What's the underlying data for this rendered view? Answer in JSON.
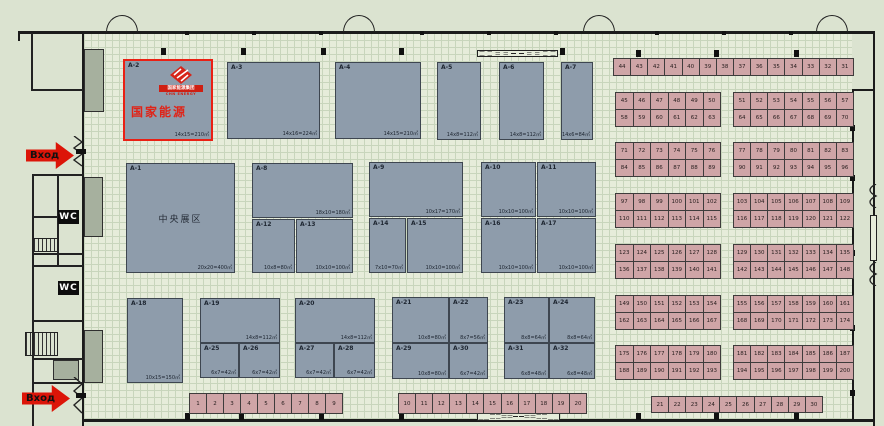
{
  "colors": {
    "highlight_red": "#ea2014",
    "booth_fill": "#8e9cab",
    "small_booth_fill": "#cfa5a7",
    "logo_red": "#cf1f12",
    "entrance_red": "#dc1508",
    "wall": "#1b1b1b"
  },
  "left_area": {
    "entrance_top_label": "Вход",
    "entrance_bottom_label": "Вход",
    "wc_label": "WC"
  },
  "hall": {
    "a2_branding": {
      "logo_banner": "国家能源集团",
      "logo_sub": "CHN ENERGY",
      "name_text": "国家能源"
    },
    "large_booths": [
      {
        "id": "A-2",
        "x": 123,
        "y": 59,
        "w": 90,
        "h": 82,
        "size": "14x15=210㎡",
        "highlight": true
      },
      {
        "id": "A-3",
        "x": 227,
        "y": 62,
        "w": 93,
        "h": 77,
        "size": "14x16=224㎡"
      },
      {
        "id": "A-4",
        "x": 335,
        "y": 62,
        "w": 86,
        "h": 77,
        "size": "14x15=210㎡"
      },
      {
        "id": "A-5",
        "x": 437,
        "y": 62,
        "w": 44,
        "h": 78,
        "size": "14x8=112㎡"
      },
      {
        "id": "A-6",
        "x": 499,
        "y": 62,
        "w": 45,
        "h": 78,
        "size": "14x8=112㎡"
      },
      {
        "id": "A-7",
        "x": 561,
        "y": 62,
        "w": 32,
        "h": 78,
        "size": "14x6=84㎡"
      },
      {
        "id": "A-1",
        "x": 126,
        "y": 163,
        "w": 109,
        "h": 110,
        "size": "20x20=400㎡",
        "center": "中央展区"
      },
      {
        "id": "A-8",
        "x": 252,
        "y": 163,
        "w": 101,
        "h": 55,
        "size": "18x10=180㎡"
      },
      {
        "id": "A-12",
        "x": 252,
        "y": 219,
        "w": 43,
        "h": 54,
        "size": "10x8=80㎡"
      },
      {
        "id": "A-13",
        "x": 296,
        "y": 219,
        "w": 57,
        "h": 54,
        "size": "10x10=100㎡"
      },
      {
        "id": "A-9",
        "x": 369,
        "y": 162,
        "w": 94,
        "h": 55,
        "size": "10x17=170㎡"
      },
      {
        "id": "A-14",
        "x": 369,
        "y": 218,
        "w": 37,
        "h": 55,
        "size": "7x10=70㎡"
      },
      {
        "id": "A-15",
        "x": 407,
        "y": 218,
        "w": 56,
        "h": 55,
        "size": "10x10=100㎡"
      },
      {
        "id": "A-10",
        "x": 481,
        "y": 162,
        "w": 55,
        "h": 55,
        "size": "10x10=100㎡"
      },
      {
        "id": "A-11",
        "x": 537,
        "y": 162,
        "w": 59,
        "h": 55,
        "size": "10x10=100㎡"
      },
      {
        "id": "A-16",
        "x": 481,
        "y": 218,
        "w": 55,
        "h": 55,
        "size": "10x10=100㎡"
      },
      {
        "id": "A-17",
        "x": 537,
        "y": 218,
        "w": 59,
        "h": 55,
        "size": "10x10=100㎡"
      },
      {
        "id": "A-18",
        "x": 127,
        "y": 298,
        "w": 56,
        "h": 85,
        "size": "10x15=150㎡"
      },
      {
        "id": "A-19",
        "x": 200,
        "y": 298,
        "w": 80,
        "h": 45,
        "size": "14x8=112㎡"
      },
      {
        "id": "A-25",
        "x": 200,
        "y": 343,
        "w": 39,
        "h": 35,
        "size": "6x7=42㎡"
      },
      {
        "id": "A-26",
        "x": 239,
        "y": 343,
        "w": 41,
        "h": 35,
        "size": "6x7=42㎡"
      },
      {
        "id": "A-20",
        "x": 295,
        "y": 298,
        "w": 80,
        "h": 45,
        "size": "14x8=112㎡"
      },
      {
        "id": "A-27",
        "x": 295,
        "y": 343,
        "w": 39,
        "h": 35,
        "size": "6x7=42㎡"
      },
      {
        "id": "A-28",
        "x": 334,
        "y": 343,
        "w": 41,
        "h": 35,
        "size": "6x7=42㎡"
      },
      {
        "id": "A-21",
        "x": 392,
        "y": 297,
        "w": 57,
        "h": 46,
        "size": "10x8=80㎡"
      },
      {
        "id": "A-22",
        "x": 449,
        "y": 297,
        "w": 39,
        "h": 46,
        "size": "8x7=56㎡"
      },
      {
        "id": "A-29",
        "x": 392,
        "y": 343,
        "w": 57,
        "h": 36,
        "size": "10x8=80㎡"
      },
      {
        "id": "A-30",
        "x": 449,
        "y": 343,
        "w": 39,
        "h": 36,
        "size": "6x7=42㎡"
      },
      {
        "id": "A-23",
        "x": 504,
        "y": 297,
        "w": 45,
        "h": 46,
        "size": "8x8=64㎡"
      },
      {
        "id": "A-24",
        "x": 549,
        "y": 297,
        "w": 46,
        "h": 46,
        "size": "8x8=64㎡"
      },
      {
        "id": "A-31",
        "x": 504,
        "y": 343,
        "w": 45,
        "h": 36,
        "size": "6x8=48㎡"
      },
      {
        "id": "A-32",
        "x": 549,
        "y": 343,
        "w": 46,
        "h": 36,
        "size": "6x8=48㎡"
      }
    ]
  },
  "small_booths": {
    "bottom_strip_1": {
      "x": 189,
      "y": 393,
      "w": 154,
      "h": 21,
      "numbers": [
        1,
        2,
        3,
        4,
        5,
        6,
        7,
        8,
        9
      ]
    },
    "bottom_strip_2": {
      "x": 398,
      "y": 393,
      "w": 189,
      "h": 21,
      "numbers": [
        10,
        11,
        12,
        13,
        14,
        15,
        16,
        17,
        18,
        19,
        20
      ]
    },
    "right_top_row": {
      "x": 613,
      "y": 58,
      "w": 241,
      "h": 18,
      "numbers": [
        44,
        43,
        42,
        41,
        40,
        39,
        38,
        37,
        36,
        35,
        34,
        33,
        32,
        31
      ]
    },
    "right_bottom_row": {
      "x": 651,
      "y": 396,
      "w": 172,
      "h": 17,
      "numbers": [
        21,
        22,
        23,
        24,
        25,
        26,
        27,
        28,
        29,
        30
      ]
    },
    "right_groups_geom": {
      "left_x": 616,
      "left_w": 105,
      "right_x": 734,
      "right_w": 120,
      "row_h": 17
    },
    "right_groups": [
      {
        "y": 93,
        "left_rows": [
          [
            45,
            46,
            47,
            48,
            49,
            50
          ],
          [
            58,
            59,
            60,
            61,
            62,
            63
          ]
        ],
        "right_rows": [
          [
            51,
            52,
            53,
            54,
            55,
            56,
            57
          ],
          [
            64,
            65,
            66,
            67,
            68,
            69,
            70
          ]
        ]
      },
      {
        "y": 143,
        "left_rows": [
          [
            71,
            72,
            73,
            74,
            75,
            76
          ],
          [
            84,
            85,
            86,
            87,
            88,
            89
          ]
        ],
        "right_rows": [
          [
            77,
            78,
            79,
            80,
            81,
            82,
            83
          ],
          [
            90,
            91,
            92,
            93,
            94,
            95,
            96
          ]
        ]
      },
      {
        "y": 194,
        "left_rows": [
          [
            97,
            98,
            99,
            100,
            101,
            102
          ],
          [
            110,
            111,
            112,
            113,
            114,
            115
          ]
        ],
        "right_rows": [
          [
            103,
            104,
            105,
            106,
            107,
            108,
            109
          ],
          [
            116,
            117,
            118,
            119,
            120,
            121,
            122
          ]
        ]
      },
      {
        "y": 245,
        "left_rows": [
          [
            123,
            124,
            125,
            126,
            127,
            128
          ],
          [
            136,
            137,
            138,
            139,
            140,
            141
          ]
        ],
        "right_rows": [
          [
            129,
            130,
            131,
            132,
            133,
            134,
            135
          ],
          [
            142,
            143,
            144,
            145,
            146,
            147,
            148
          ]
        ]
      },
      {
        "y": 296,
        "left_rows": [
          [
            149,
            150,
            151,
            152,
            153,
            154
          ],
          [
            162,
            163,
            164,
            165,
            166,
            167
          ]
        ],
        "right_rows": [
          [
            155,
            156,
            157,
            158,
            159,
            160,
            161
          ],
          [
            168,
            169,
            170,
            171,
            172,
            173,
            174
          ]
        ]
      },
      {
        "y": 346,
        "left_rows": [
          [
            175,
            176,
            177,
            178,
            179,
            180
          ],
          [
            188,
            189,
            190,
            191,
            192,
            193
          ]
        ],
        "right_rows": [
          [
            181,
            182,
            183,
            184,
            185,
            186,
            187
          ],
          [
            194,
            195,
            196,
            197,
            198,
            199,
            200
          ]
        ]
      }
    ]
  }
}
